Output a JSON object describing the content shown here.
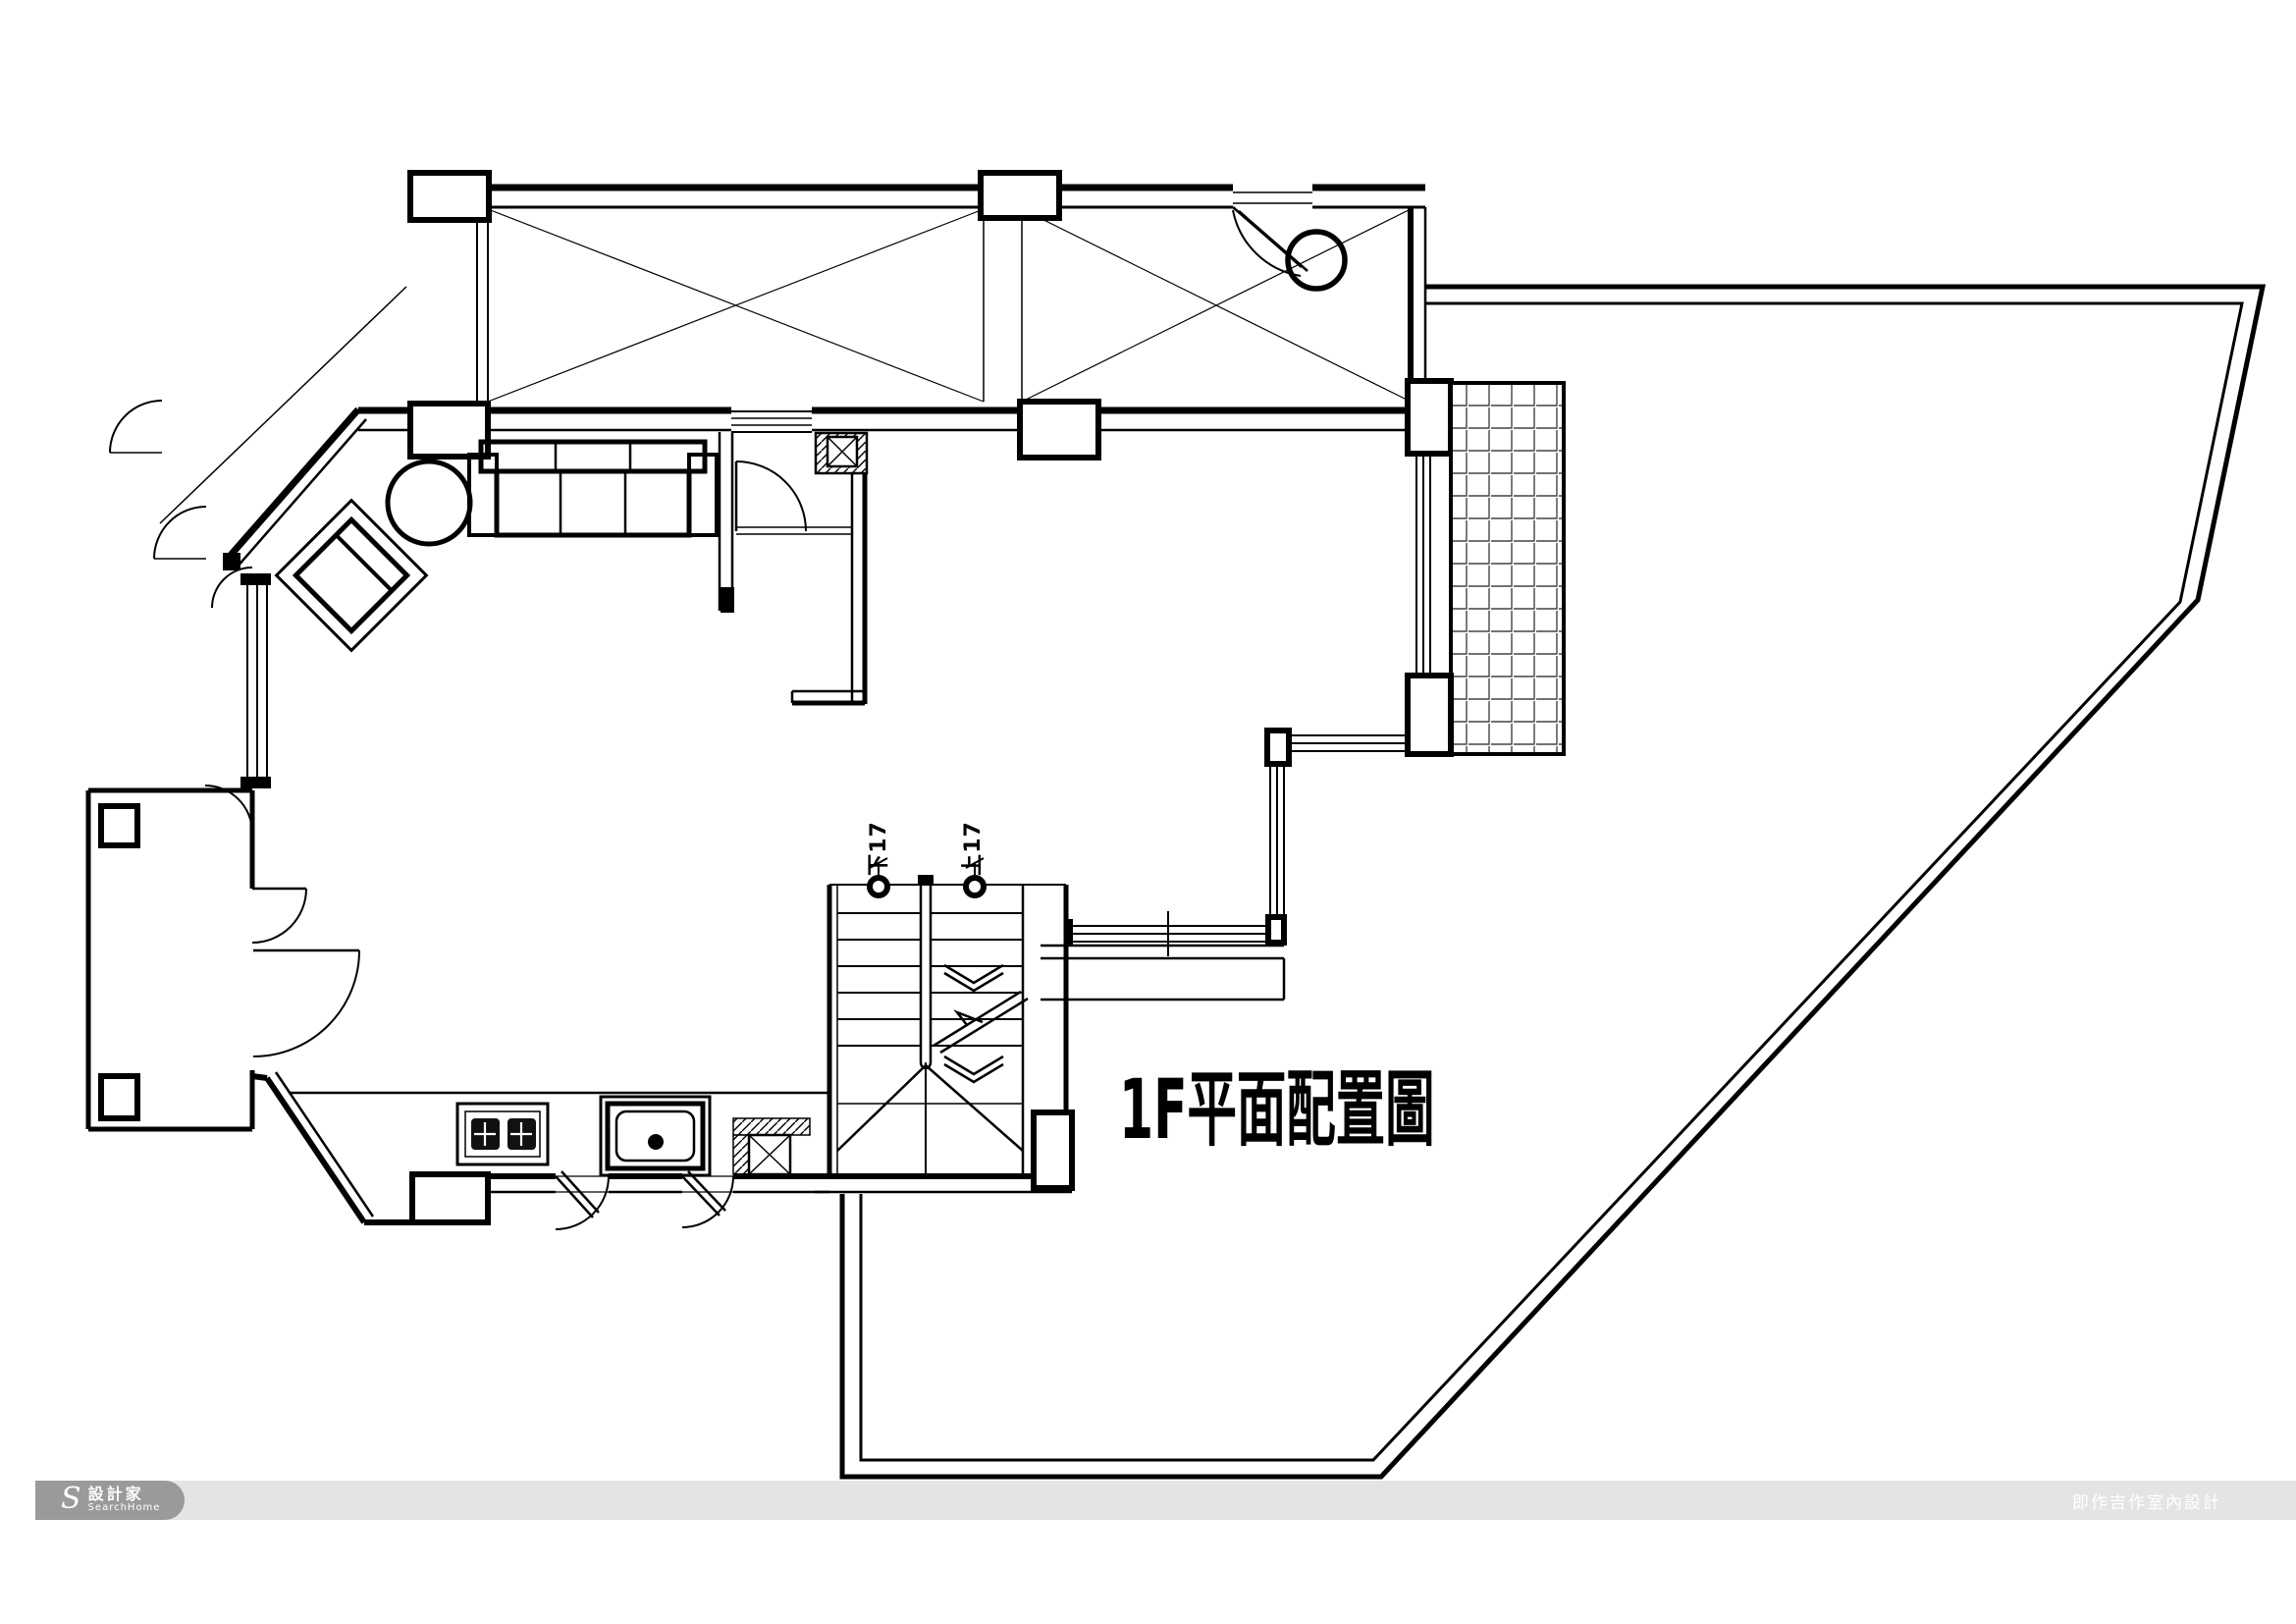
{
  "drawing": {
    "title": "1F平面配置圖",
    "stair_down_label": "下17",
    "stair_up_label": "上17"
  },
  "footer": {
    "brand_mark": "S",
    "brand_cn": "設計家",
    "brand_en": "SearchHome",
    "credit": "即作吉作室內設計"
  },
  "colors": {
    "line": "#000000",
    "paper": "#ffffff",
    "footer_bar": "#e4e4e4",
    "footer_brand": "#9a9a9a",
    "footer_text": "#ffffff"
  }
}
